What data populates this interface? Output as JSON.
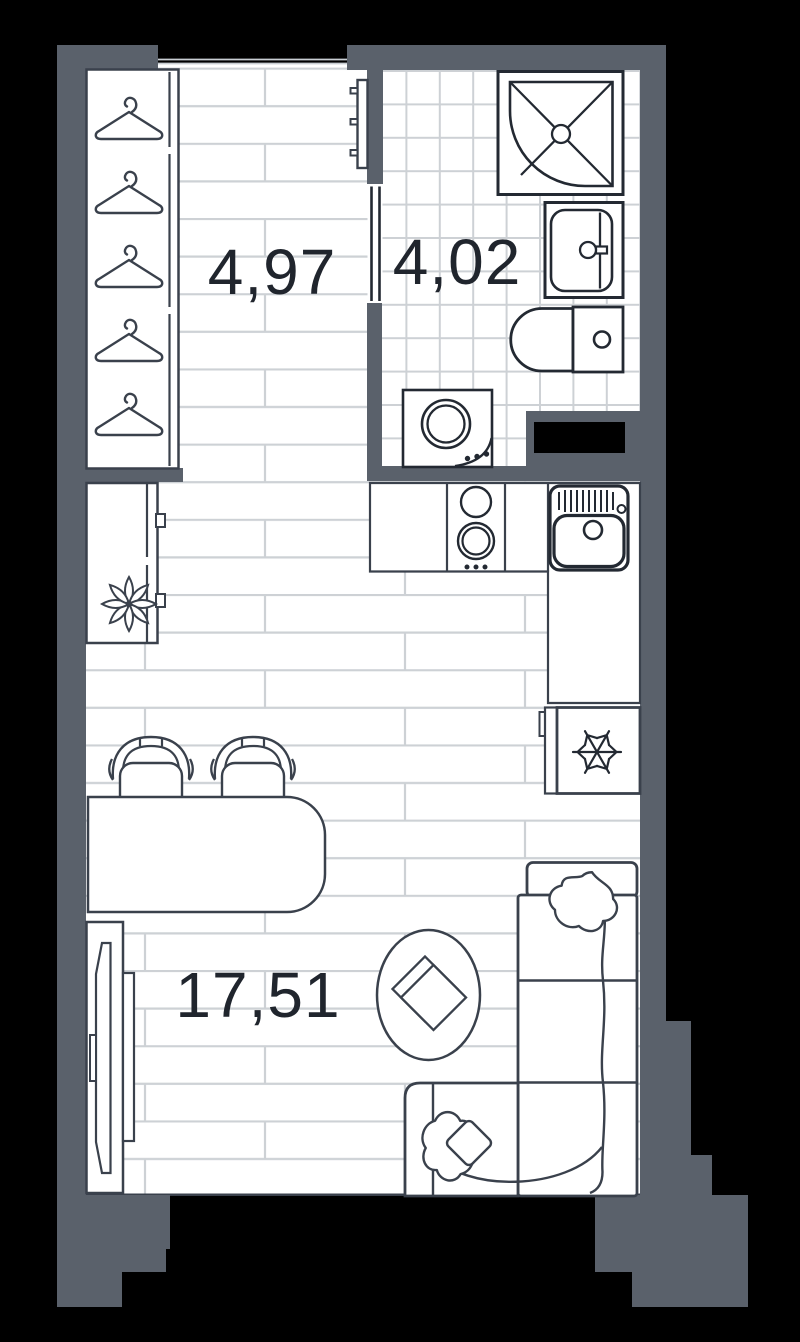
{
  "plan": {
    "type": "apartment-floor-plan",
    "background": "#000000",
    "colors": {
      "wall": "#5a616b",
      "line": "#3a414c",
      "bold_line": "#232932",
      "floor_line": "#cdd1d5",
      "label": "#20252d",
      "fixture_fill": "#ffffff",
      "shaft": "#000000"
    },
    "rooms": {
      "hallway": {
        "area": "4,97"
      },
      "bathroom": {
        "area": "4,02"
      },
      "living_kitchen": {
        "area": "17,51"
      }
    },
    "fixtures": [
      "wardrobe-with-hangers",
      "entrance-door",
      "bathroom-door",
      "shower-cabin",
      "washbasin",
      "toilet",
      "washing-machine",
      "ventilation-shaft",
      "kitchen-counter",
      "cooktop",
      "kitchen-sink",
      "refrigerator",
      "cabinet-with-plant",
      "dining-table",
      "chairs",
      "tv-stand",
      "rug",
      "corner-sofa",
      "pillows"
    ]
  }
}
